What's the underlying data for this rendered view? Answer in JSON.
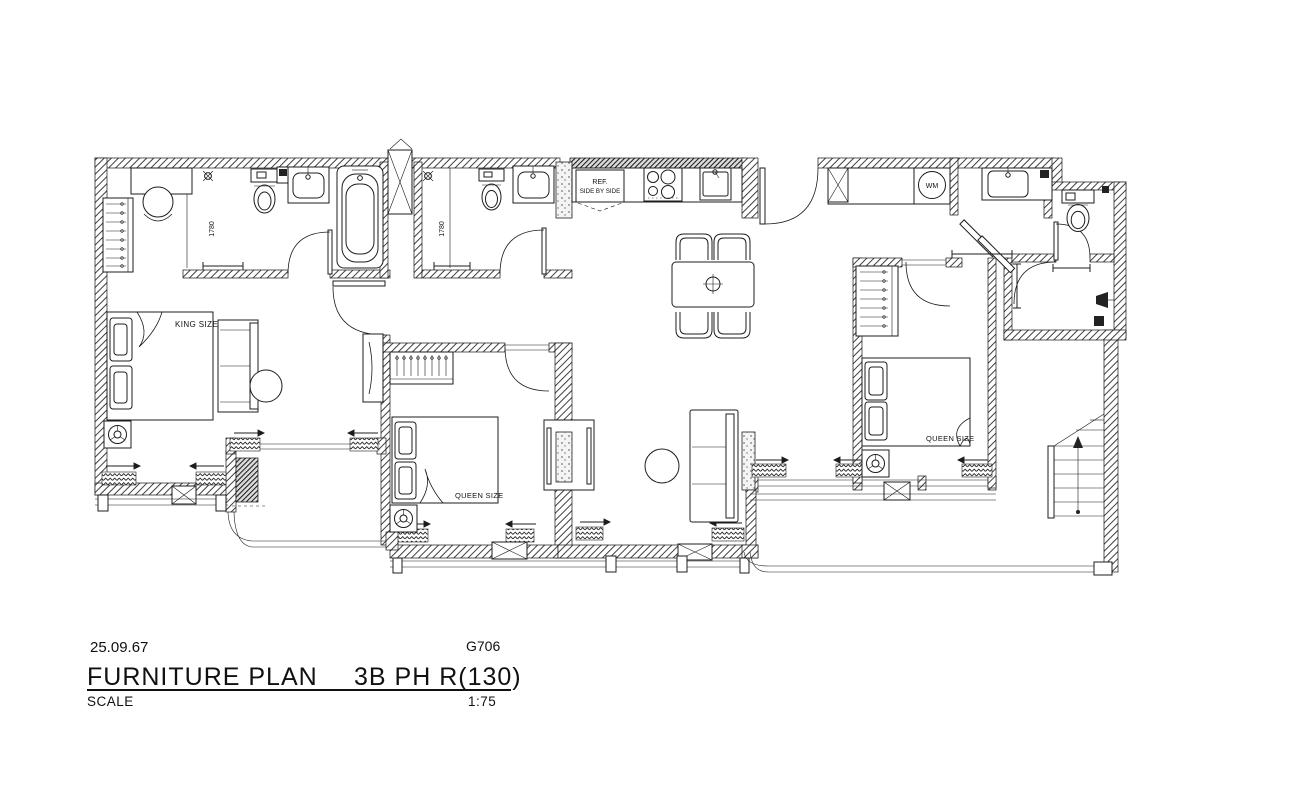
{
  "document": {
    "date": "25.09.67",
    "drawing_code": "G706",
    "title": "FURNITURE PLAN",
    "unit_label": "3B PH R(130)",
    "scale_label": "SCALE",
    "scale_value": "1:75"
  },
  "plan": {
    "bedroom_1_bed": "KING SIZE",
    "bedroom_2_bed": "QUEEN SIZE",
    "bedroom_3_bed": "QUEEN SIZE",
    "shower_1_dim": "1780",
    "shower_2_dim": "1780",
    "fridge_label_1": "REF.",
    "fridge_label_2": "SIDE BY SIDE",
    "washer_label": "WM"
  },
  "colors": {
    "ink": "#1a1a1a",
    "paper": "#ffffff",
    "wall_hatch": "#3f3f3f"
  }
}
